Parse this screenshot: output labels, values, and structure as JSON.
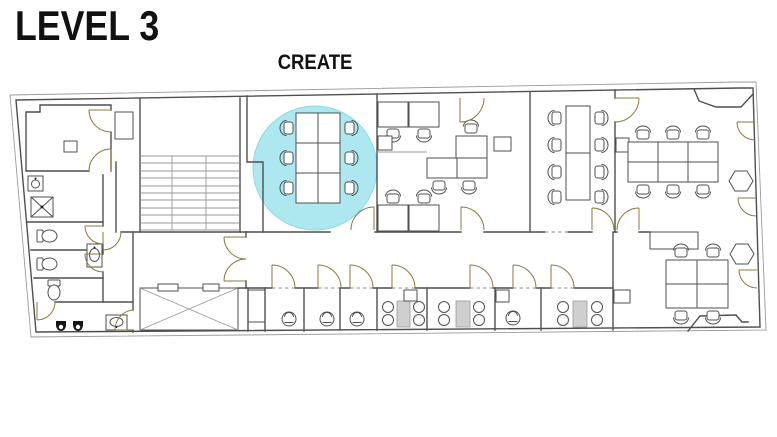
{
  "header": {
    "title": "LEVEL 3"
  },
  "plan": {
    "room_label": "CREATE",
    "highlighted_room": "CREATE",
    "colors": {
      "highlight_fill": "#ade8f0",
      "highlight_stroke": "#8fd9e6",
      "wall": "#4f4f4f",
      "wall_light": "#9a9a9a",
      "door": "#8a7a3c",
      "booth_table_fill": "#cfcfcf",
      "fixture_black": "#151515",
      "page_bg": "#ffffff"
    }
  }
}
